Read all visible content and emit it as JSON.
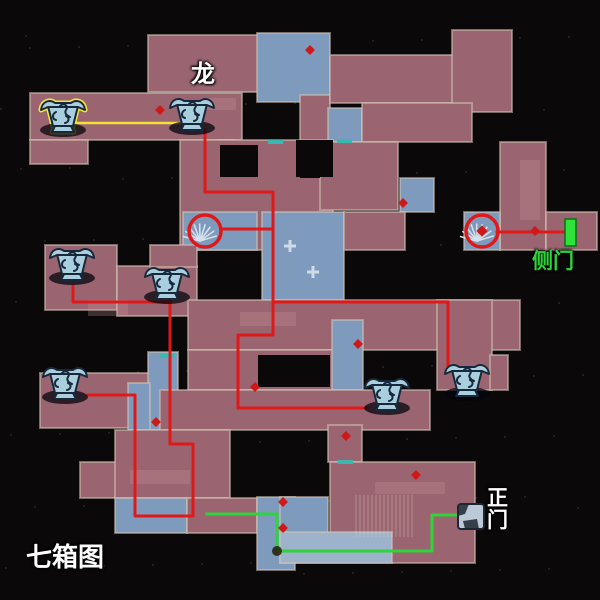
{
  "map_title": "七箱图",
  "canvas": {
    "w": 600,
    "h": 600,
    "bg": "#0b0809"
  },
  "palette": {
    "mauve": "#9a6470",
    "blue": "#7e9bbd",
    "lightblue": "#9db3cc",
    "wall": "#cfc2b2",
    "red": "#e01818",
    "yellow": "#f2e23a",
    "green": "#2ed43a",
    "cyan": "#3ab8b0",
    "white": "#ffffff",
    "chest_fill": "#a9cede",
    "chest_line": "#16283a",
    "exit_green": "#2ee23c",
    "diamond_red": "#d01818"
  },
  "labels": [
    {
      "id": "dragon",
      "text": "龙",
      "x": 191,
      "y": 62,
      "size": 24,
      "color": "#ffffff"
    },
    {
      "id": "side-door",
      "text": "侧门",
      "x": 532,
      "y": 251,
      "size": 21,
      "color": "#2ed43a"
    },
    {
      "id": "main-gate",
      "text": "正\n门",
      "x": 487,
      "y": 488,
      "size": 21,
      "color": "#ffffff"
    },
    {
      "id": "seven-boxes",
      "text": "七箱图",
      "x": 26,
      "y": 544,
      "size": 26,
      "color": "#ffffff"
    }
  ],
  "rooms": [
    {
      "x": 148,
      "y": 35,
      "w": 110,
      "h": 57,
      "c": "mauve"
    },
    {
      "x": 257,
      "y": 33,
      "w": 73,
      "h": 69,
      "c": "blue"
    },
    {
      "x": 300,
      "y": 95,
      "w": 30,
      "h": 47,
      "c": "mauve"
    },
    {
      "x": 328,
      "y": 108,
      "w": 34,
      "h": 34,
      "c": "blue"
    },
    {
      "x": 330,
      "y": 55,
      "w": 124,
      "h": 48,
      "c": "mauve"
    },
    {
      "x": 452,
      "y": 30,
      "w": 60,
      "h": 82,
      "c": "mauve"
    },
    {
      "x": 362,
      "y": 103,
      "w": 110,
      "h": 39,
      "c": "mauve"
    },
    {
      "x": 30,
      "y": 93,
      "w": 212,
      "h": 47,
      "c": "mauve"
    },
    {
      "x": 30,
      "y": 140,
      "w": 58,
      "h": 24,
      "c": "mauve"
    },
    {
      "x": 218,
      "y": 140,
      "w": 16,
      "h": 76,
      "c": "mauve"
    },
    {
      "x": 180,
      "y": 140,
      "w": 153,
      "h": 110,
      "c": "mauve"
    },
    {
      "x": 320,
      "y": 142,
      "w": 78,
      "h": 68,
      "c": "mauve"
    },
    {
      "x": 400,
      "y": 178,
      "w": 34,
      "h": 34,
      "c": "blue"
    },
    {
      "x": 183,
      "y": 212,
      "w": 74,
      "h": 38,
      "c": "blue"
    },
    {
      "x": 262,
      "y": 212,
      "w": 82,
      "h": 88,
      "c": "blue"
    },
    {
      "x": 344,
      "y": 212,
      "w": 61,
      "h": 38,
      "c": "mauve"
    },
    {
      "x": 500,
      "y": 142,
      "w": 46,
      "h": 108,
      "c": "mauve"
    },
    {
      "x": 546,
      "y": 212,
      "w": 51,
      "h": 38,
      "c": "mauve"
    },
    {
      "x": 464,
      "y": 212,
      "w": 36,
      "h": 38,
      "c": "blue"
    },
    {
      "x": 45,
      "y": 245,
      "w": 72,
      "h": 65,
      "c": "mauve"
    },
    {
      "x": 117,
      "y": 266,
      "w": 80,
      "h": 50,
      "c": "mauve"
    },
    {
      "x": 150,
      "y": 245,
      "w": 47,
      "h": 22,
      "c": "mauve"
    },
    {
      "x": 188,
      "y": 300,
      "w": 332,
      "h": 50,
      "c": "mauve"
    },
    {
      "x": 188,
      "y": 350,
      "w": 145,
      "h": 40,
      "c": "mauve"
    },
    {
      "x": 332,
      "y": 320,
      "w": 31,
      "h": 70,
      "c": "blue"
    },
    {
      "x": 437,
      "y": 300,
      "w": 55,
      "h": 90,
      "c": "mauve"
    },
    {
      "x": 490,
      "y": 355,
      "w": 18,
      "h": 35,
      "c": "mauve"
    },
    {
      "x": 40,
      "y": 373,
      "w": 120,
      "h": 55,
      "c": "mauve"
    },
    {
      "x": 148,
      "y": 352,
      "w": 30,
      "h": 78,
      "c": "blue"
    },
    {
      "x": 128,
      "y": 383,
      "w": 22,
      "h": 47,
      "c": "blue"
    },
    {
      "x": 160,
      "y": 390,
      "w": 270,
      "h": 40,
      "c": "mauve"
    },
    {
      "x": 80,
      "y": 462,
      "w": 42,
      "h": 36,
      "c": "mauve"
    },
    {
      "x": 115,
      "y": 430,
      "w": 115,
      "h": 68,
      "c": "mauve"
    },
    {
      "x": 115,
      "y": 498,
      "w": 72,
      "h": 35,
      "c": "blue"
    },
    {
      "x": 187,
      "y": 498,
      "w": 70,
      "h": 35,
      "c": "mauve"
    },
    {
      "x": 257,
      "y": 497,
      "w": 38,
      "h": 73,
      "c": "blue"
    },
    {
      "x": 328,
      "y": 425,
      "w": 34,
      "h": 37,
      "c": "mauve"
    },
    {
      "x": 330,
      "y": 462,
      "w": 145,
      "h": 101,
      "c": "mauve"
    },
    {
      "x": 280,
      "y": 497,
      "w": 48,
      "h": 66,
      "c": "blue"
    },
    {
      "x": 280,
      "y": 532,
      "w": 112,
      "h": 31,
      "c": "lightblue"
    }
  ],
  "holes": [
    {
      "x": 220,
      "y": 145,
      "w": 38,
      "h": 32
    },
    {
      "x": 296,
      "y": 140,
      "w": 37,
      "h": 37
    },
    {
      "x": 300,
      "y": 142,
      "w": 20,
      "h": 36
    },
    {
      "x": 258,
      "y": 355,
      "w": 72,
      "h": 32
    }
  ],
  "tints": [
    {
      "x": 88,
      "y": 300,
      "w": 40,
      "h": 16
    },
    {
      "x": 240,
      "y": 312,
      "w": 56,
      "h": 14
    },
    {
      "x": 200,
      "y": 98,
      "w": 36,
      "h": 12
    },
    {
      "x": 375,
      "y": 482,
      "w": 70,
      "h": 12
    },
    {
      "x": 130,
      "y": 470,
      "w": 60,
      "h": 14
    },
    {
      "x": 520,
      "y": 160,
      "w": 20,
      "h": 60
    }
  ],
  "paths": [
    {
      "id": "yellow-route",
      "color": "yellow",
      "w": 2.5,
      "pts": [
        [
          63,
          123
        ],
        [
          196,
          123
        ]
      ]
    },
    {
      "id": "red-route-dragon",
      "color": "red",
      "w": 3,
      "pts": [
        [
          205,
          130
        ],
        [
          205,
          192
        ],
        [
          273,
          192
        ],
        [
          273,
          335
        ],
        [
          238,
          335
        ],
        [
          238,
          408
        ],
        [
          368,
          408
        ]
      ]
    },
    {
      "id": "red-route-spiral-spur",
      "color": "red",
      "w": 3,
      "pts": [
        [
          273,
          229
        ],
        [
          224,
          229
        ]
      ]
    },
    {
      "id": "red-route-east",
      "color": "red",
      "w": 3,
      "pts": [
        [
          273,
          302
        ],
        [
          448,
          302
        ],
        [
          448,
          368
        ]
      ]
    },
    {
      "id": "red-route-left",
      "color": "red",
      "w": 3,
      "pts": [
        [
          73,
          286
        ],
        [
          73,
          302
        ],
        [
          170,
          302
        ]
      ]
    },
    {
      "id": "red-route-south",
      "color": "red",
      "w": 3,
      "pts": [
        [
          170,
          299
        ],
        [
          170,
          444
        ],
        [
          193,
          444
        ],
        [
          193,
          516
        ],
        [
          135,
          516
        ],
        [
          135,
          395
        ],
        [
          88,
          395
        ]
      ]
    },
    {
      "id": "red-route-sidedoor",
      "color": "red",
      "w": 3,
      "pts": [
        [
          497,
          232
        ],
        [
          570,
          232
        ]
      ]
    },
    {
      "id": "green-route-maingate",
      "color": "green",
      "w": 3,
      "pts": [
        [
          207,
          514
        ],
        [
          277,
          514
        ],
        [
          277,
          551
        ],
        [
          432,
          551
        ],
        [
          432,
          515
        ],
        [
          460,
          515
        ]
      ]
    }
  ],
  "chests": [
    {
      "id": "chest-1",
      "x": 63,
      "y": 115,
      "glow": true
    },
    {
      "id": "chest-2",
      "x": 192,
      "y": 113,
      "glow": false
    },
    {
      "id": "chest-3",
      "x": 72,
      "y": 263,
      "glow": false
    },
    {
      "id": "chest-4",
      "x": 167,
      "y": 282,
      "glow": false
    },
    {
      "id": "chest-5",
      "x": 65,
      "y": 382,
      "glow": false
    },
    {
      "id": "chest-6",
      "x": 387,
      "y": 393,
      "glow": false
    },
    {
      "id": "chest-7",
      "x": 467,
      "y": 379,
      "glow": false
    }
  ],
  "spawn_circles": [
    {
      "id": "spiral-stairs-1",
      "x": 205,
      "y": 231,
      "r": 16,
      "diamond": false
    },
    {
      "id": "spiral-stairs-2",
      "x": 482,
      "y": 231,
      "r": 16,
      "diamond": true
    }
  ],
  "gate_icon": {
    "x": 471,
    "y": 516
  },
  "exit_marker": {
    "x": 565,
    "y": 219,
    "w": 11,
    "h": 27
  },
  "diamonds": [
    {
      "x": 160,
      "y": 110
    },
    {
      "x": 310,
      "y": 50
    },
    {
      "x": 403,
      "y": 203
    },
    {
      "x": 535,
      "y": 231
    },
    {
      "x": 346,
      "y": 436
    },
    {
      "x": 416,
      "y": 475
    },
    {
      "x": 283,
      "y": 502
    },
    {
      "x": 283,
      "y": 528
    },
    {
      "x": 255,
      "y": 387
    },
    {
      "x": 358,
      "y": 344
    },
    {
      "x": 156,
      "y": 422
    }
  ],
  "cyan_doors": [
    {
      "x": 268,
      "y": 140
    },
    {
      "x": 337,
      "y": 139
    },
    {
      "x": 338,
      "y": 460
    },
    {
      "x": 160,
      "y": 354
    }
  ],
  "plus_marks": [
    {
      "x": 290,
      "y": 246
    },
    {
      "x": 313,
      "y": 272
    }
  ],
  "blobs": [
    {
      "x": 277,
      "y": 551
    }
  ],
  "stairs": {
    "x": 356,
    "y": 495,
    "w": 58,
    "h": 42,
    "step": 4
  }
}
